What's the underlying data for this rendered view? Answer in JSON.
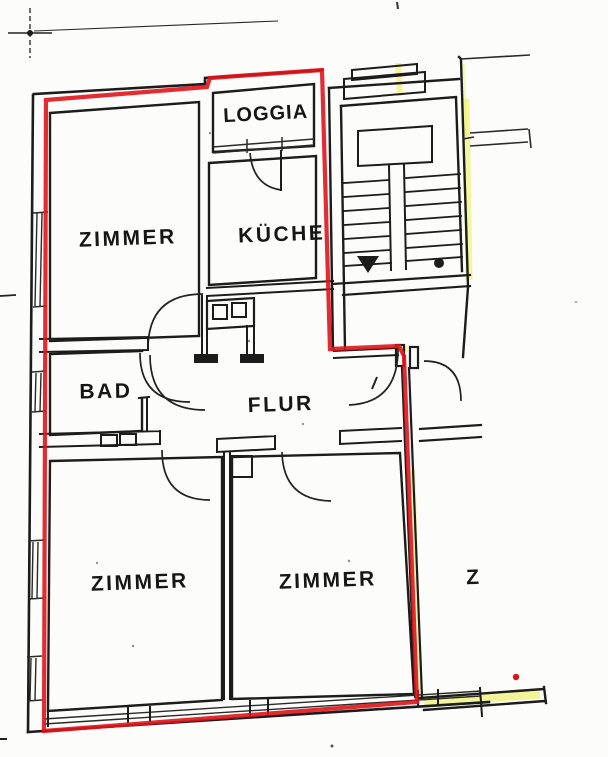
{
  "plan": {
    "title_hint": "apartment floor plan scan",
    "rooms": {
      "loggia": {
        "label": "LOGGIA"
      },
      "zimmer_top_left": {
        "label": "ZIMMER"
      },
      "kueche": {
        "label": "KÜCHE"
      },
      "bad": {
        "label": "BAD"
      },
      "flur": {
        "label": "FLUR"
      },
      "zimmer_bottom_left": {
        "label": "ZIMMER"
      },
      "zimmer_bottom_right": {
        "label": "ZIMMER"
      },
      "neighbor_room_partial": {
        "label": "Z"
      }
    },
    "colors": {
      "apartment_outline_red": "#e0151c",
      "marker_highlight_yellow": "#eef063",
      "wall_ink": "#1c1c1c",
      "paper": "#fcfcfa"
    }
  }
}
